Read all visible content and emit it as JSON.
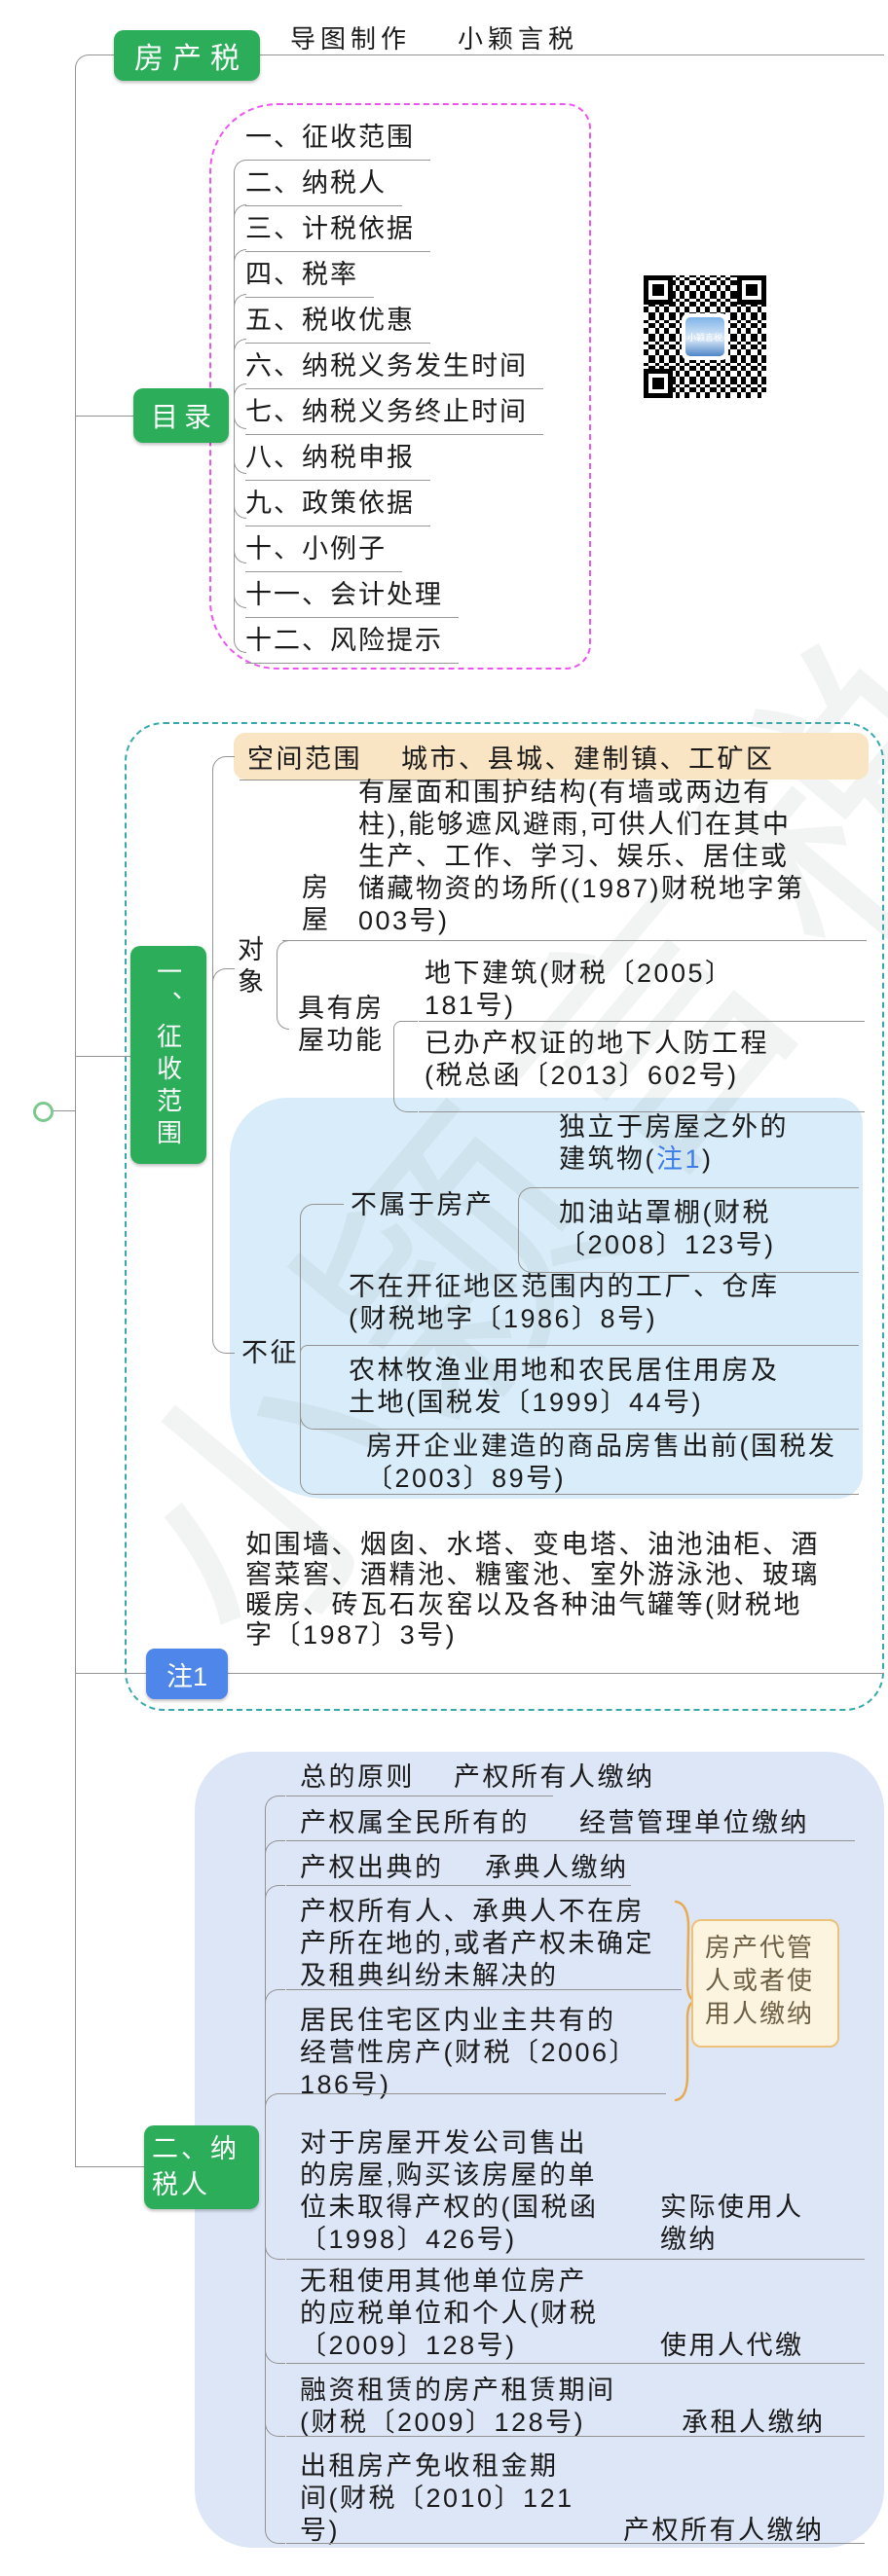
{
  "root": {
    "label": "房产税"
  },
  "credits": {
    "maker": "导图制作",
    "author": "小颖言税"
  },
  "qr": {
    "caption": "小颖言税"
  },
  "watermark": {
    "text": "小颖言税"
  },
  "toc": {
    "label": "目录",
    "items": [
      "一、征收范围",
      "二、纳税人",
      "三、计税依据",
      "四、税率",
      "五、税收优惠",
      "六、纳税义务发生时间",
      "七、纳税义务终止时间",
      "八、纳税申报",
      "九、政策依据",
      "十、小例子",
      "十一、会计处理",
      "十二、风险提示"
    ]
  },
  "scope": {
    "label": "一、征收范围",
    "space": {
      "label": "空间范围",
      "value": "城市、县城、建制镇、工矿区"
    },
    "object": {
      "label": "对象",
      "house_label": "房屋",
      "house_text": "有屋面和围护结构(有墙或两边有柱),能够遮风避雨,可供人们在其中生产、工作、学习、娱乐、居住或储藏物资的场所((1987)财税地字第003号)",
      "function_label": "具有房屋功能",
      "underground": "地下建筑(财税〔2005〕181号)",
      "civil_defense": "已办产权证的地下人防工程(税总函〔2013〕602号)"
    },
    "not_levy": {
      "label": "不征",
      "not_property_label": "不属于房产",
      "independent_pre": "独立于房屋之外的建筑物(",
      "independent_ref": "注1",
      "independent_post": ")",
      "gas_station": "加油站罩棚(财税〔2008〕123号)",
      "factory": "不在开征地区范围内的工厂、仓库(财税地字〔1986〕8号)",
      "agriculture": "农林牧渔业用地和农民居住用房及土地(国税发〔1999〕44号)",
      "developer": "房开企业建造的商品房售出前(国税发〔2003〕89号)"
    }
  },
  "note1": {
    "label": "注1",
    "text": "如围墙、烟囱、水塔、变电塔、油池油柜、酒窖菜窖、酒精池、糖蜜池、室外游泳池、玻璃暖房、砖瓦石灰窑以及各种油气罐等(财税地字〔1987〕3号)"
  },
  "taxpayer": {
    "label": "二、纳税人",
    "rows": [
      {
        "label": "总的原则",
        "value": "产权所有人缴纳"
      },
      {
        "label": "产权属全民所有的",
        "value": "经营管理单位缴纳"
      },
      {
        "label": "产权出典的",
        "value": "承典人缴纳"
      }
    ],
    "group": {
      "case1": "产权所有人、承典人不在房产所在地的,或者产权未确定及租典纠纷未解决的",
      "case2": "居民住宅区内业主共有的经营性房产(财税〔2006〕186号)",
      "payer": "房产代管人或者使用人缴纳"
    },
    "rows2": [
      {
        "label": "对于房屋开发公司售出的房屋,购买该房屋的单位未取得产权的(国税函〔1998〕426号)",
        "value": "实际使用人缴纳"
      },
      {
        "label": "无租使用其他单位房产的应税单位和个人(财税〔2009〕128号)",
        "value": "使用人代缴"
      },
      {
        "label": "融资租赁的房产租赁期间(财税〔2009〕128号)",
        "value": "承租人缴纳"
      },
      {
        "label": "出租房产免收租金期间(财税〔2010〕121号)",
        "value": "产权所有人缴纳"
      }
    ]
  },
  "colors": {
    "node_green": "#2bad5a",
    "toc_border": "#ee55ee",
    "scope_border": "#35a9ab",
    "space_bg": "#f9e4c4",
    "not_levy_bg": "#d8edf9",
    "taxpayer_bg": "#dde6f7",
    "note_blue": "#4f86ea",
    "ref_blue": "#3d7be8",
    "brace_orange": "#e8aa50",
    "payer_box_bg": "#fdf4df",
    "payer_box_border": "#ecc27a"
  }
}
